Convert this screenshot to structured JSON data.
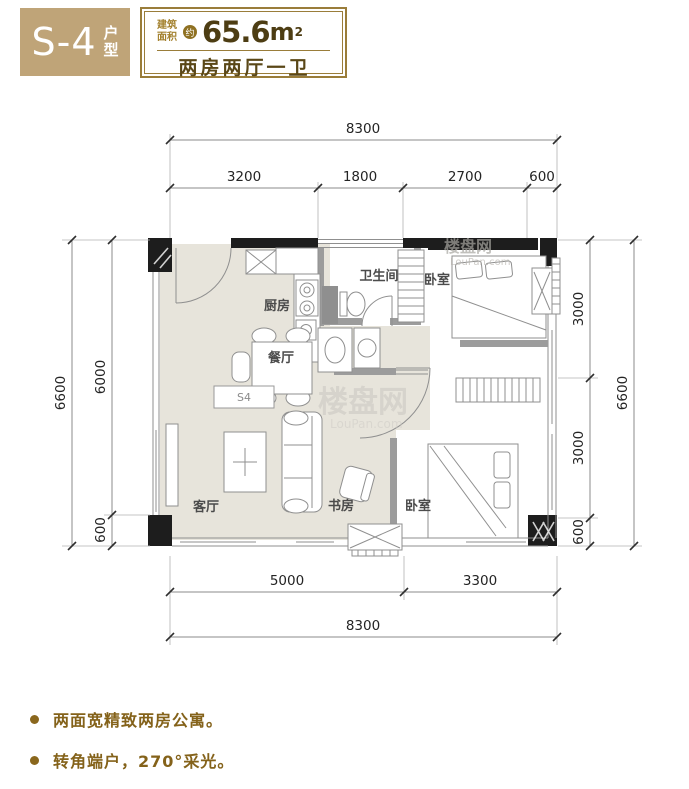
{
  "header": {
    "unit_code": "S-4",
    "unit_suffix_1": "户",
    "unit_suffix_2": "型",
    "area_label_1": "建筑",
    "area_label_2": "面积",
    "approx_badge": "约",
    "area_value": "65.6",
    "area_unit": "m",
    "area_exponent": "2",
    "layout_text": "两房两厅一卫"
  },
  "plan": {
    "unit_label": "S4",
    "rooms": {
      "kitchen": "厨房",
      "bathroom": "卫生间",
      "bedroom_top": "卧室",
      "dining": "餐厅",
      "living": "客厅",
      "study": "书房",
      "bedroom_bottom": "卧室"
    },
    "dims": {
      "top": {
        "total": "8300",
        "segs": [
          "3200",
          "1800",
          "2700",
          "600"
        ]
      },
      "left": {
        "outer": "6600",
        "segs": [
          "6000",
          "600"
        ]
      },
      "right": {
        "segs": [
          "3000",
          "3000",
          "600"
        ],
        "outer": "6600"
      },
      "bottom": {
        "segs": [
          "5000",
          "3300"
        ],
        "total": "8300"
      }
    },
    "watermark": {
      "cn": "楼盘网",
      "en": "LouPan.com"
    }
  },
  "features": [
    {
      "text": "两面宽精致两房公寓。"
    },
    {
      "text": "转角端户，270°采光。"
    }
  ],
  "colors": {
    "badge_bg": "#bfa478",
    "gold_border": "#9a7d3a",
    "gold_text": "#a3812e",
    "dark_brown": "#4d3d13",
    "feature_gold": "#84621a",
    "floor": "#e7e4db",
    "wall_black": "#1d1d1d",
    "wall_gray": "#9c9c9c"
  }
}
